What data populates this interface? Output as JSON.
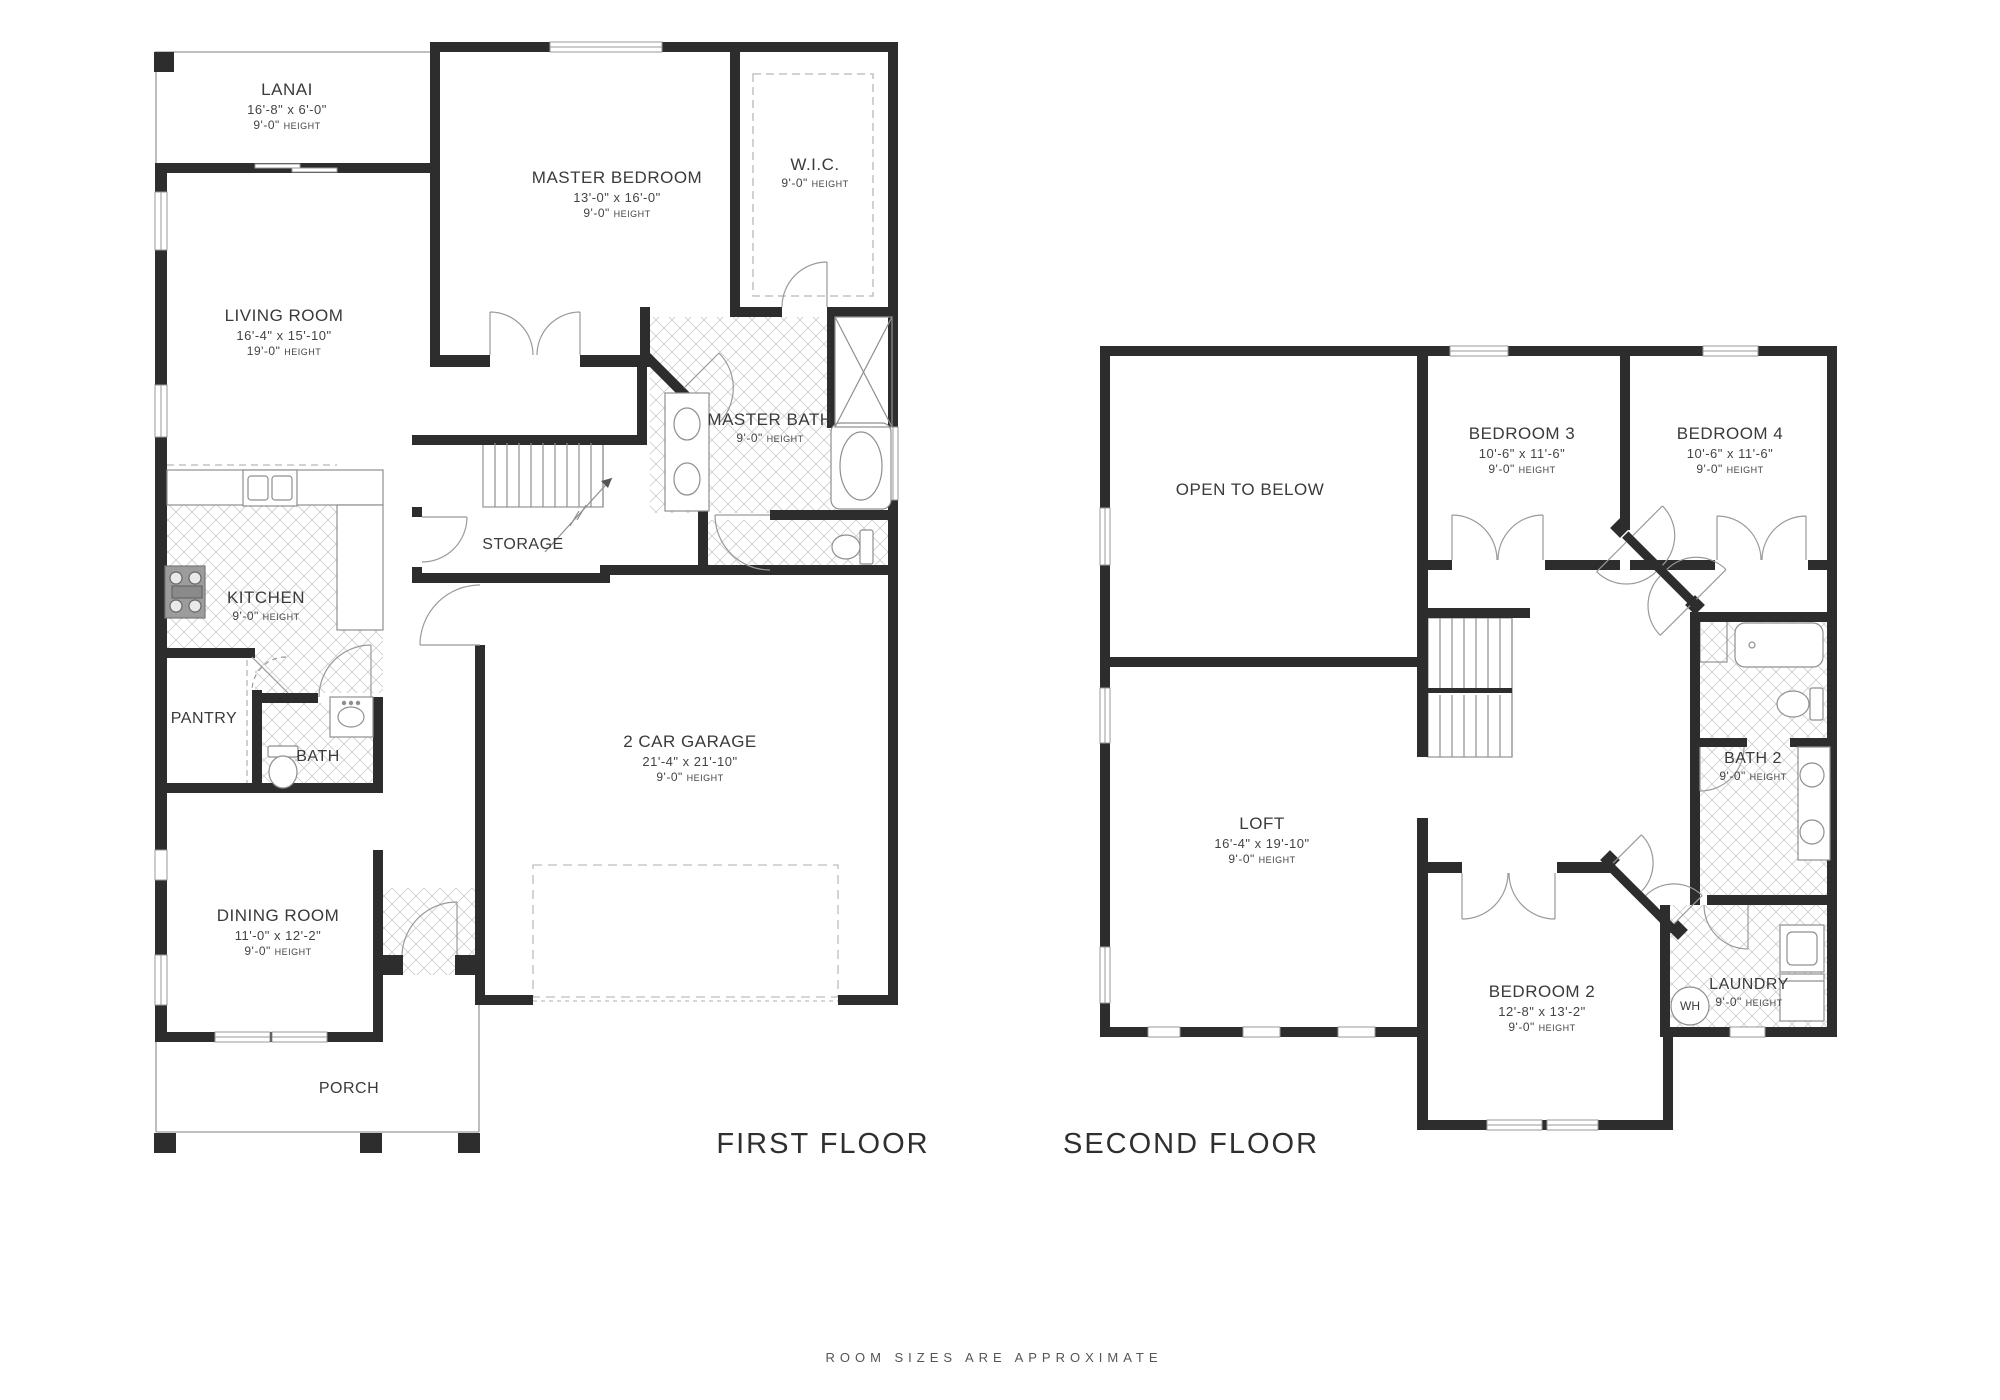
{
  "labels": {
    "height_word": "HEIGHT"
  },
  "colors": {
    "wall": "#2d2d2d",
    "line": "#9a9a9a",
    "text": "#3a3a3a",
    "background": "#ffffff"
  },
  "footnote": "ROOM SIZES ARE APPROXIMATE",
  "first_floor": {
    "title": "FIRST FLOOR",
    "rooms": {
      "lanai": {
        "name": "LANAI",
        "dims": "16'-8\" x 6'-0\"",
        "height": "9'-0\""
      },
      "master_bedroom": {
        "name": "MASTER BEDROOM",
        "dims": "13'-0\" x 16'-0\"",
        "height": "9'-0\""
      },
      "wic": {
        "name": "W.I.C.",
        "height": "9'-0\""
      },
      "living_room": {
        "name": "LIVING ROOM",
        "dims": "16'-4\" x 15'-10\"",
        "height": "19'-0\""
      },
      "master_bath": {
        "name": "MASTER BATH",
        "height": "9'-0\""
      },
      "storage": {
        "name": "STORAGE"
      },
      "kitchen": {
        "name": "KITCHEN",
        "height": "9'-0\""
      },
      "pantry": {
        "name": "PANTRY"
      },
      "bath": {
        "name": "BATH"
      },
      "garage": {
        "name": "2 CAR GARAGE",
        "dims": "21'-4\" x 21'-10\"",
        "height": "9'-0\""
      },
      "dining_room": {
        "name": "DINING ROOM",
        "dims": "11'-0\" x 12'-2\"",
        "height": "9'-0\""
      },
      "porch": {
        "name": "PORCH"
      }
    }
  },
  "second_floor": {
    "title": "SECOND FLOOR",
    "rooms": {
      "open_to_below": {
        "name": "OPEN TO BELOW"
      },
      "bedroom3": {
        "name": "BEDROOM 3",
        "dims": "10'-6\" x 11'-6\"",
        "height": "9'-0\""
      },
      "bedroom4": {
        "name": "BEDROOM 4",
        "dims": "10'-6\" x 11'-6\"",
        "height": "9'-0\""
      },
      "loft": {
        "name": "LOFT",
        "dims": "16'-4\" x 19'-10\"",
        "height": "9'-0\""
      },
      "bath2": {
        "name": "BATH 2",
        "height": "9'-0\""
      },
      "bedroom2": {
        "name": "BEDROOM 2",
        "dims": "12'-8\" x 13'-2\"",
        "height": "9'-0\""
      },
      "laundry": {
        "name": "LAUNDRY",
        "height": "9'-0\""
      },
      "wh": {
        "name": "WH"
      }
    }
  }
}
